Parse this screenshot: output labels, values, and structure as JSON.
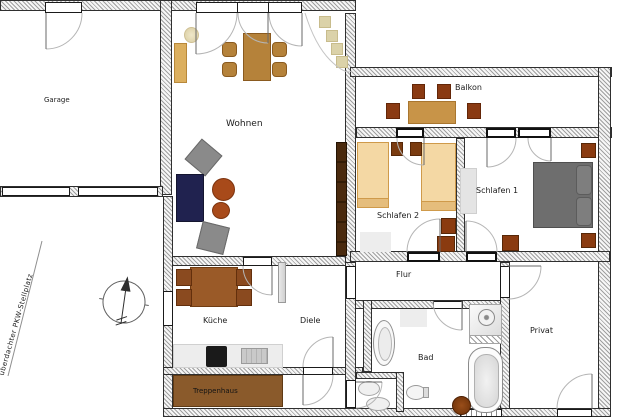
{
  "rooms": {
    "garage": "Garage",
    "wohnen": "Wohnen",
    "balkon": "Balkon",
    "schlafen1": "Schlafen 1",
    "schlafen2": "Schlafen 2",
    "flur": "Flur",
    "diele": "Diele",
    "kueche": "Küche",
    "bad": "Bad",
    "privat": "Privat",
    "treppenhaus": "Treppenhaus"
  },
  "annotations": {
    "parking": "überdachter PKW-Stellplatz"
  },
  "icons": {
    "compass": "north-arrow-icon"
  },
  "colors": {
    "wall_outline": "#2f2f2f",
    "bed_tan": "#f4d8a4",
    "bed_tan_border": "#cf9a4a",
    "furniture_brown": "#8a3b10",
    "dining_table_brown": "#b5823a",
    "balcony_table": "#c89448",
    "sofa_navy": "#20224f",
    "armchair_gray": "#8a8a8a",
    "double_bed_gray": "#6e6e6e",
    "stair_brown": "#8a5a2b",
    "dark_wardrobe": "#3a2008",
    "kitchen_table": "#9a5a28"
  }
}
